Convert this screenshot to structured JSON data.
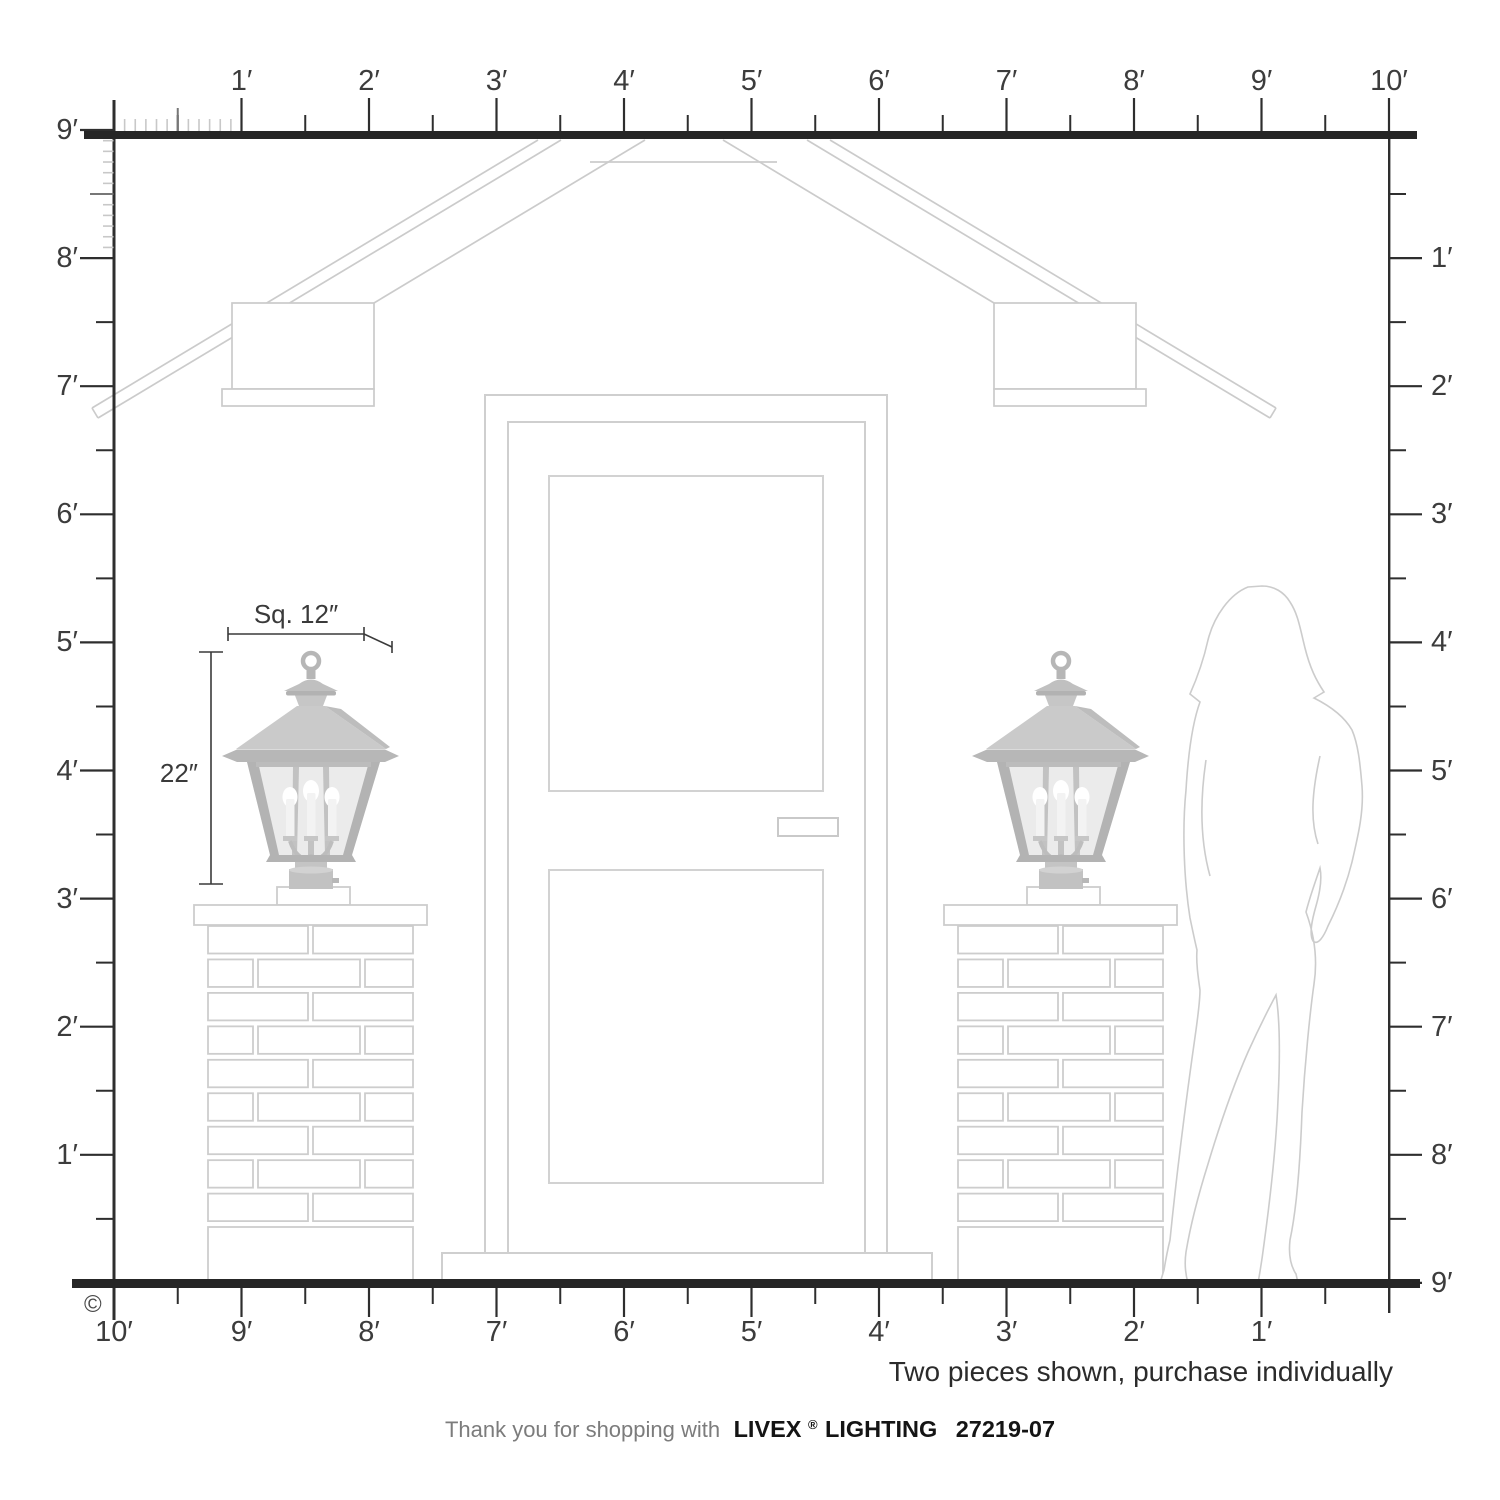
{
  "rulers": {
    "top": {
      "labels": [
        "1′",
        "2′",
        "3′",
        "4′",
        "5′",
        "6′",
        "7′",
        "8′",
        "9′",
        "10′"
      ]
    },
    "left": {
      "labels": [
        "9′",
        "8′",
        "7′",
        "6′",
        "5′",
        "4′",
        "3′",
        "2′",
        "1′"
      ]
    },
    "right": {
      "labels": [
        "1′",
        "2′",
        "3′",
        "4′",
        "5′",
        "6′",
        "7′",
        "8′",
        "9′"
      ]
    },
    "bottom": {
      "labels": [
        "10′",
        "9′",
        "8′",
        "7′",
        "6′",
        "5′",
        "4′",
        "3′",
        "2′",
        "1′"
      ]
    }
  },
  "dimensions": {
    "width_label": "Sq. 12″",
    "height_label": "22″"
  },
  "note": {
    "purchase": "Two pieces shown, purchase individually"
  },
  "footer": {
    "prefix": "Thank you for shopping with",
    "brand": "LIVEX",
    "registered": "®",
    "brand_suffix": "LIGHTING",
    "model": "27219-07"
  },
  "copyright": "©",
  "colors": {
    "ruler_ink": "#2e2e2e",
    "label_ink": "#3c3c3c",
    "minor_tick": "#c8c8c8",
    "line_art": "#cdcdcd",
    "lantern_metal": "#b6b6b6",
    "lantern_glass": "#ebebeb",
    "note_ink": "#2b2b2b",
    "footer_muted": "#7c7c7c",
    "footer_ink": "#141414"
  }
}
